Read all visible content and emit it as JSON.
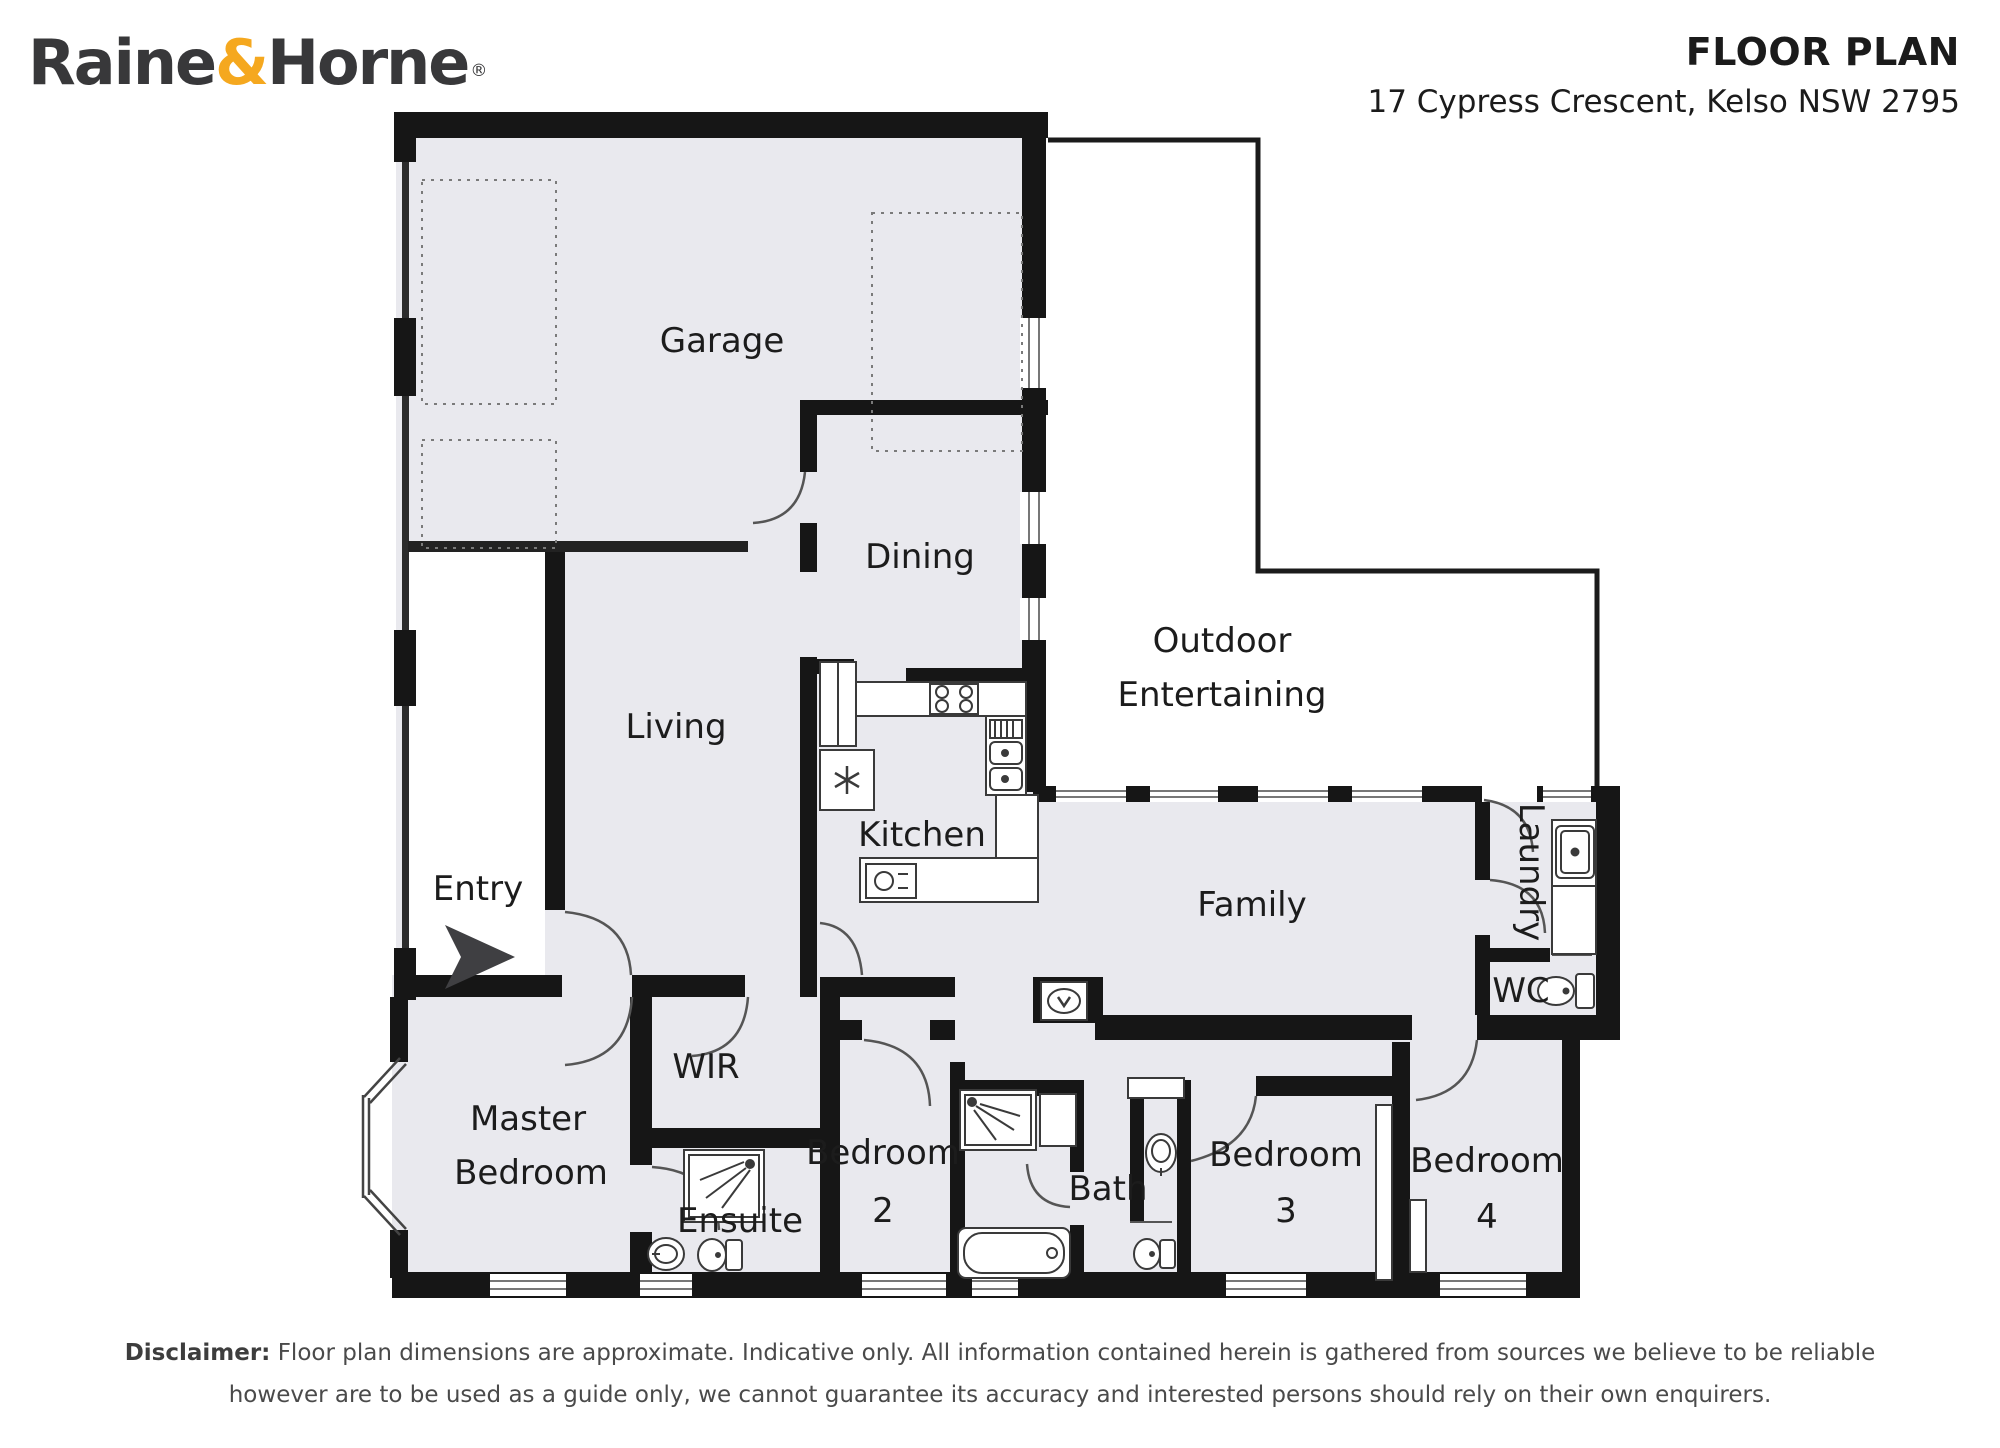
{
  "header": {
    "title": "FLOOR PLAN",
    "address": "17 Cypress Crescent, Kelso NSW 2795",
    "logo": {
      "raine": "Raine",
      "amp": "&",
      "horne": "Horne",
      "reg": "®"
    }
  },
  "rooms": {
    "garage": "Garage",
    "dining": "Dining",
    "living": "Living",
    "entry": "Entry",
    "kitchen": "Kitchen",
    "outdoor_line1": "Outdoor",
    "outdoor_line2": "Entertaining",
    "family": "Family",
    "laundry": "Laundry",
    "wc": "WC",
    "wir": "WIR",
    "master_line1": "Master",
    "master_line2": "Bedroom",
    "ensuite": "Ensuite",
    "bedroom2_line1": "Bedroom",
    "bedroom2_line2": "2",
    "bath": "Bath",
    "bedroom3_line1": "Bedroom",
    "bedroom3_line2": "3",
    "bedroom4_line1": "Bedroom",
    "bedroom4_line2": "4"
  },
  "disclaimer": {
    "label": "Disclaimer:",
    "line1": "Floor plan dimensions are approximate. Indicative only. All information contained herein is gathered from sources we believe to be reliable",
    "line2": "however are to be used as a guide only, we cannot guarantee its accuracy and interested persons should rely on their own enquirers."
  },
  "colors": {
    "accent_orange": "#F5A81F",
    "wall_black": "#161616",
    "room_fill": "#e9e9ee",
    "logo_gray": "#38383a"
  }
}
